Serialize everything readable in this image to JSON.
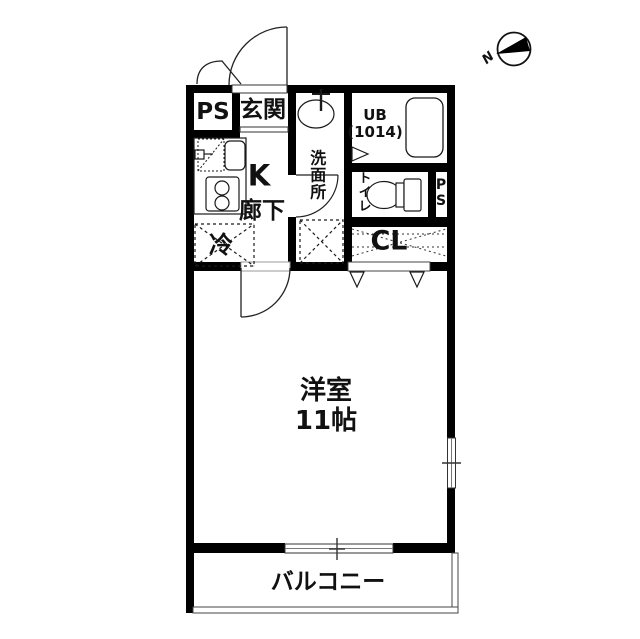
{
  "compass": {
    "north_label": "N"
  },
  "rooms": {
    "ps_top": {
      "label": "PS"
    },
    "entrance": {
      "label": "玄関"
    },
    "unit_bath": {
      "label": "UB\n(1014)"
    },
    "washroom": {
      "label": "洗面所"
    },
    "kitchen": {
      "label": "K"
    },
    "hallway": {
      "label": "廊下"
    },
    "toilet": {
      "label": "トイレ"
    },
    "ps_right": {
      "label": "PS"
    },
    "refrigerator": {
      "label": "冷"
    },
    "closet": {
      "label": "CL"
    },
    "main_room": {
      "label": "洋室\n11帖"
    },
    "balcony": {
      "label": "バルコニー"
    }
  },
  "colors": {
    "wall": "#000000",
    "line": "#1a1a1a",
    "thin_frame": "#555555",
    "background": "#ffffff"
  }
}
